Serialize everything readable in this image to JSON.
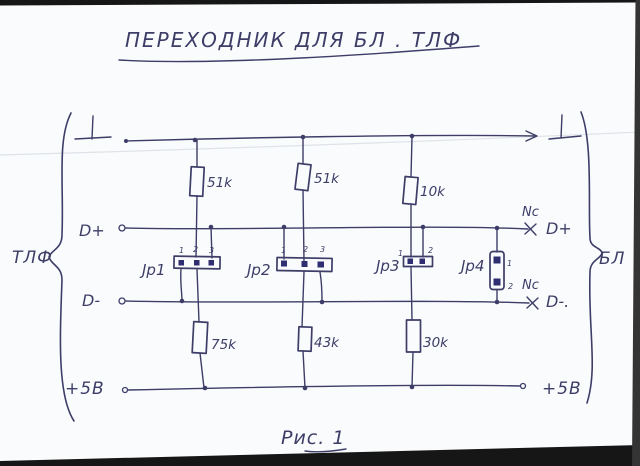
{
  "photo": {
    "ink_color": "#3d3d68",
    "paper_color": "#fafbfc",
    "border_color": "#161616",
    "pad_color": "#2e2e70"
  },
  "title": {
    "text": "ПЕРЕХОДНИК  ДЛЯ  БЛ . ТЛФ"
  },
  "caption": {
    "text": "Рис. 1"
  },
  "left_group": {
    "brace_label": "ТЛФ"
  },
  "right_group": {
    "brace_label": "БЛ"
  },
  "rails": {
    "dplus_left": "D+",
    "dplus_right": "D+",
    "dplus_nc": "Nc",
    "dminus_left": "D-",
    "dminus_right": "D-.",
    "dminus_nc": "Nc",
    "p5v_left": "+5В",
    "p5v_right": "+5В"
  },
  "resistors": [
    {
      "value": "51k"
    },
    {
      "value": "51k"
    },
    {
      "value": "10k"
    },
    {
      "value": "75k"
    },
    {
      "value": "43k"
    },
    {
      "value": "30k"
    }
  ],
  "jumpers": [
    {
      "label": "Jp1",
      "pins": [
        "1",
        "2",
        "3"
      ]
    },
    {
      "label": "Jp2",
      "pins": [
        "1",
        "2",
        "3"
      ]
    },
    {
      "label": "Jp3",
      "pins": [
        "1",
        "2"
      ]
    },
    {
      "label": "Jp4",
      "pins": [
        "1",
        "2"
      ]
    }
  ]
}
